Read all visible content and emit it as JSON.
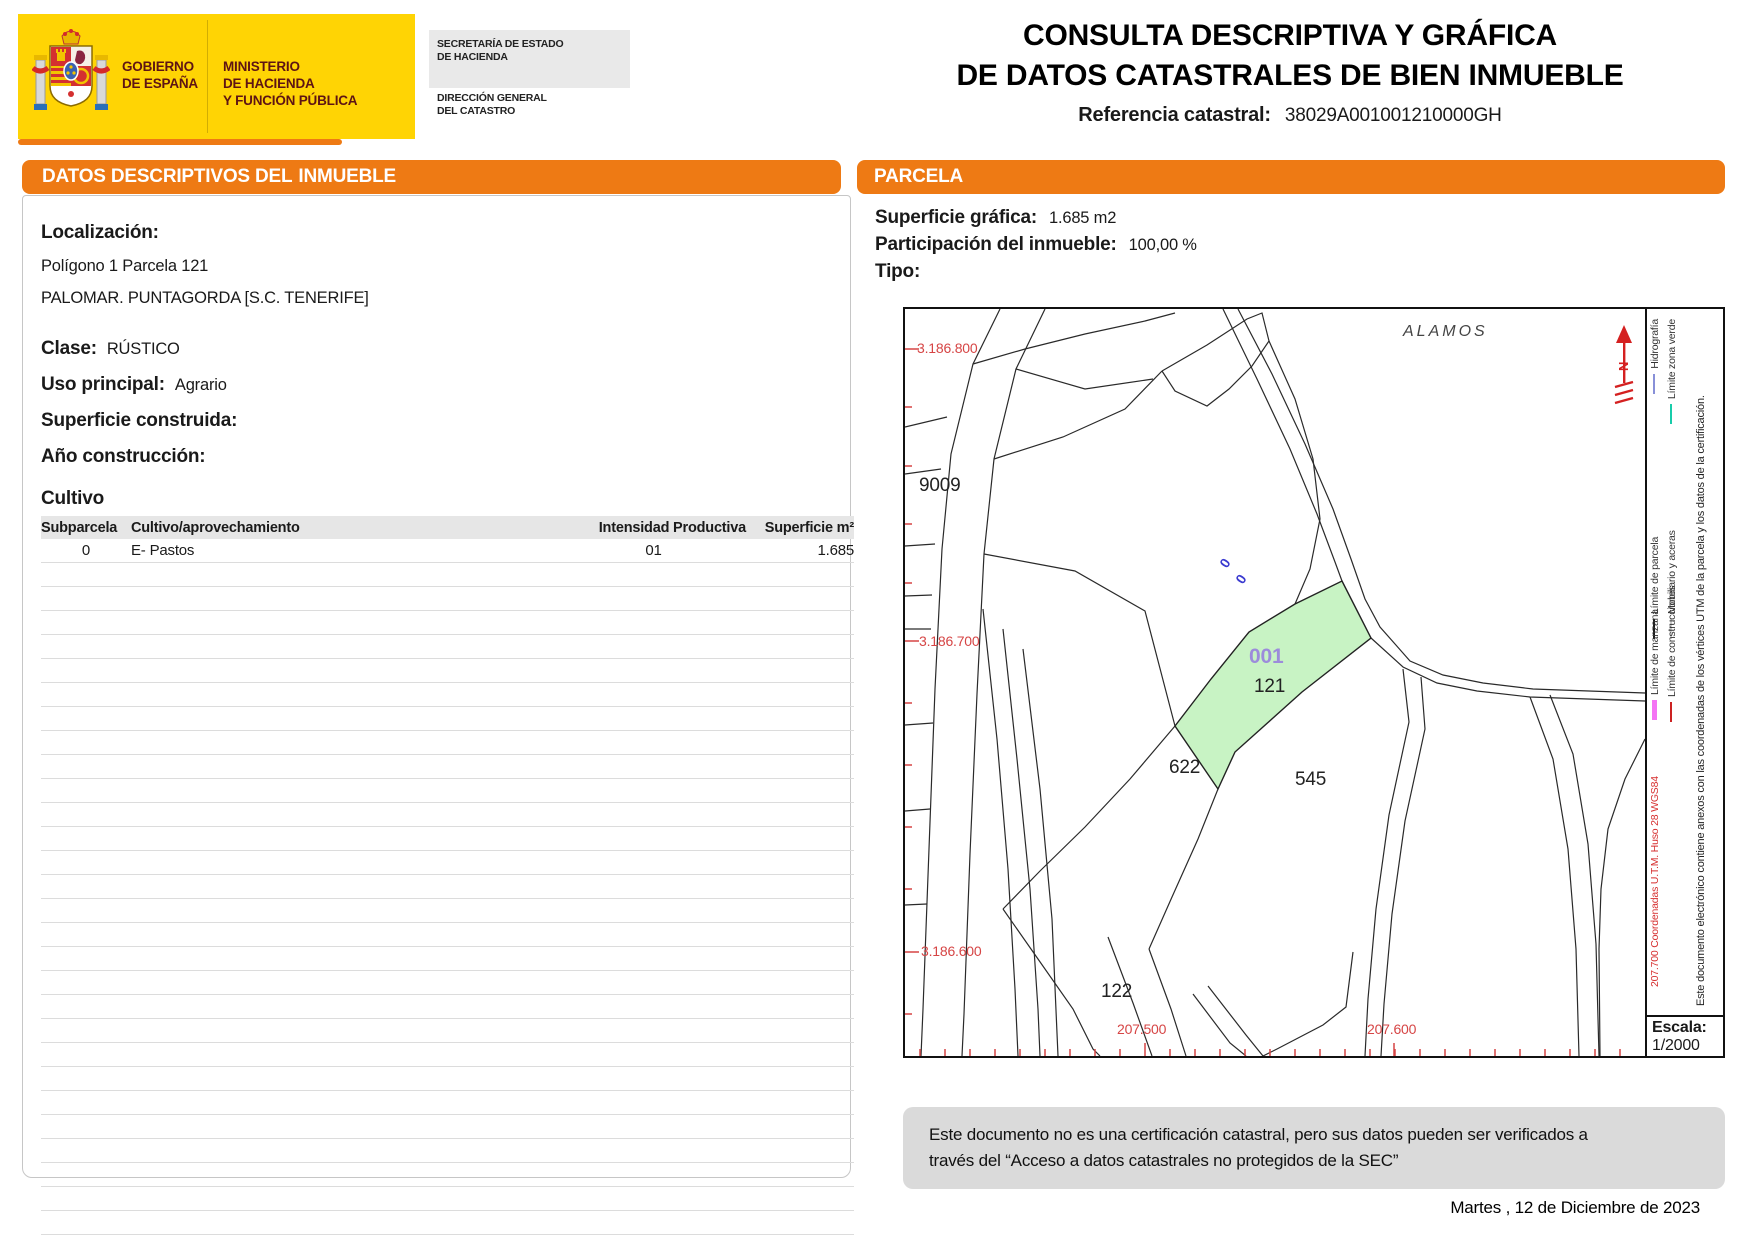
{
  "header": {
    "gobierno_line1": "GOBIERNO",
    "gobierno_line2": "DE ESPAÑA",
    "ministerio_lines": [
      "MINISTERIO",
      "DE HACIENDA",
      "Y FUNCIÓN PÚBLICA"
    ],
    "secretaria_line1": "SECRETARÍA DE ESTADO",
    "secretaria_line2": "DE HACIENDA",
    "direccion_line1": "DIRECCIÓN GENERAL",
    "direccion_line2": "DEL CATASTRO",
    "title_line1": "CONSULTA DESCRIPTIVA Y GRÁFICA",
    "title_line2": "DE DATOS CATASTRALES DE BIEN INMUEBLE",
    "ref_label": "Referencia catastral:",
    "ref_value": "38029A001001210000GH"
  },
  "left_panel": {
    "header_prefix": "DATOS DESCRIPTIVOS DEL",
    "header_emphasis": "INMUEBLE",
    "localizacion_label": "Localización:",
    "localizacion_line1": "Polígono 1 Parcela 121",
    "localizacion_line2": "PALOMAR. PUNTAGORDA [S.C. TENERIFE]",
    "clase_label": "Clase:",
    "clase_value": "RÚSTICO",
    "uso_label": "Uso principal:",
    "uso_value": "Agrario",
    "superficie_label": "Superficie construida:",
    "superficie_value": "",
    "anio_label": "Año construcción:",
    "anio_value": "",
    "cultivo_title": "Cultivo",
    "table": {
      "columns": [
        "Subparcela",
        "Cultivo/aprovechamiento",
        "Intensidad Productiva",
        "Superficie m²"
      ],
      "rows": [
        [
          "0",
          "E- Pastos",
          "01",
          "1.685"
        ]
      ],
      "empty_row_count": 28
    }
  },
  "right_panel": {
    "header": "PARCELA",
    "superficie_label": "Superficie gráfica:",
    "superficie_value": "1.685 m2",
    "participacion_label": "Participación del inmueble:",
    "participacion_value": "100,00 %",
    "tipo_label": "Tipo:",
    "tipo_value": ""
  },
  "map": {
    "north_label": "N",
    "labels": [
      {
        "text": "ALAMOS",
        "x": 498,
        "y": 14,
        "cls": "lbl-place"
      },
      {
        "text": "9009",
        "x": 14,
        "y": 166,
        "cls": "lbl-parcel"
      },
      {
        "text": "001",
        "x": 344,
        "y": 336,
        "cls": "lbl-sub"
      },
      {
        "text": "121",
        "x": 349,
        "y": 367,
        "cls": "lbl-parcel"
      },
      {
        "text": "622",
        "x": 264,
        "y": 448,
        "cls": "lbl-parcel"
      },
      {
        "text": "545",
        "x": 390,
        "y": 460,
        "cls": "lbl-parcel"
      },
      {
        "text": "122",
        "x": 196,
        "y": 672,
        "cls": "lbl-parcel"
      },
      {
        "text": "0",
        "x": 316,
        "y": 246,
        "cls": "lbl-hydro",
        "rot": -55
      },
      {
        "text": "0",
        "x": 332,
        "y": 262,
        "cls": "lbl-hydro",
        "rot": -55
      },
      {
        "text": "3.186.800",
        "x": 12,
        "y": 31,
        "cls": "lbl-coord"
      },
      {
        "text": "3.186.700",
        "x": 14,
        "y": 324,
        "cls": "lbl-coord"
      },
      {
        "text": "3.186.600",
        "x": 16,
        "y": 634,
        "cls": "lbl-coord"
      },
      {
        "text": "207.500",
        "x": 212,
        "y": 712,
        "cls": "lbl-coord"
      },
      {
        "text": "207.600",
        "x": 462,
        "y": 712,
        "cls": "lbl-coord"
      }
    ],
    "legend": {
      "pairs": [
        {
          "x": 744,
          "y": 330,
          "w": 320,
          "items": [
            {
              "label": "Límite de parcela",
              "color": "#1a1a1a",
              "thick": 2
            },
            {
              "label": "Hidrografía",
              "color": "#8890D8",
              "thick": 2
            }
          ]
        },
        {
          "x": 761,
          "y": 330,
          "w": 320,
          "items": [
            {
              "label": "Mobiliario y aceras",
              "color": "#CFCFCF",
              "thick": 2
            },
            {
              "label": "Límite zona verde",
              "color": "#18CCAA",
              "thick": 2
            }
          ]
        },
        {
          "x": 744,
          "y": 411,
          "w": 120,
          "items": [
            {
              "label": "Límite de manzana",
              "color": "#F473F4",
              "thick": 5
            }
          ]
        },
        {
          "x": 761,
          "y": 413,
          "w": 145,
          "items": [
            {
              "label": "Límite de construcciones",
              "color": "#CC2222",
              "thick": 2
            }
          ]
        }
      ],
      "coords_note": "207.700 Coordenadas U.T.M. Huso 28 WGS84",
      "cert_note": "Este documento electrónico contiene anexos con las coordenadas de los vértices UTM de la parcela y los datos de la certificación.",
      "escala_label": "Escala:",
      "escala_value": "1/2000"
    },
    "parcel_fill": "#C8F3C4",
    "coord_color": "#D64545"
  },
  "footer": {
    "disclaimer_line1": "Este documento no es una certificación catastral, pero sus datos pueden ser verificados a",
    "disclaimer_line2": "través del “Acceso a datos catastrales no protegidos de la SEC”",
    "date": "Martes , 12 de Diciembre de 2023"
  },
  "colors": {
    "orange": "#EE7A14",
    "logo_yellow": "#FFD404",
    "logo_text": "#5E1414",
    "parcel_green": "#C8F3C4",
    "parcel_number_purple": "#9C8CDB",
    "map_coord_red": "#D64545"
  }
}
